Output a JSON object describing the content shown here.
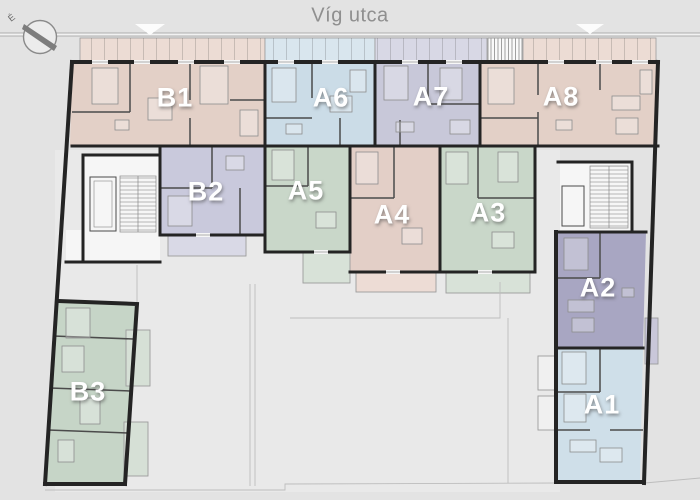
{
  "street_label": "Víg utca",
  "compass": {
    "label": "É",
    "icon": "north-arrow"
  },
  "entrance_marker_icon": "triangle-down",
  "colors": {
    "bg": "#e3e3e3",
    "courtyard": "#e9e9e9",
    "wall": "#242424",
    "pathline": "#bdbdbd",
    "streettext": "#8f8f8f",
    "labeltext": "#ffffff"
  },
  "apartments": [
    {
      "id": "B1",
      "label": "B1",
      "color": "#e3d0c7",
      "terrace_color": "#ecdcd4"
    },
    {
      "id": "A6",
      "label": "A6",
      "color": "#cbdce7",
      "terrace_color": "#d9e6ee"
    },
    {
      "id": "A7",
      "label": "A7",
      "color": "#c8c8d9",
      "terrace_color": "#d8d8e5"
    },
    {
      "id": "A8",
      "label": "A8",
      "color": "#e3d0c7",
      "terrace_color": "#ecdcd4"
    },
    {
      "id": "B2",
      "label": "B2",
      "color": "#c9c9dc",
      "terrace_color": "#d9d9e6"
    },
    {
      "id": "A5",
      "label": "A5",
      "color": "#c9d7c9",
      "terrace_color": "#d8e2d8"
    },
    {
      "id": "A4",
      "label": "A4",
      "color": "#e3cfc7",
      "terrace_color": "#eddcd5"
    },
    {
      "id": "A3",
      "label": "A3",
      "color": "#c9d7c9",
      "terrace_color": "#d8e2d8"
    },
    {
      "id": "A2",
      "label": "A2",
      "color": "#a8a6c2",
      "terrace_color": "#c9c7d9"
    },
    {
      "id": "A1",
      "label": "A1",
      "color": "#cfdfe9",
      "terrace_color": "#f0f0f0"
    },
    {
      "id": "B3",
      "label": "B3",
      "color": "#c6d5c7",
      "terrace_color": "#d6e0d6"
    }
  ]
}
